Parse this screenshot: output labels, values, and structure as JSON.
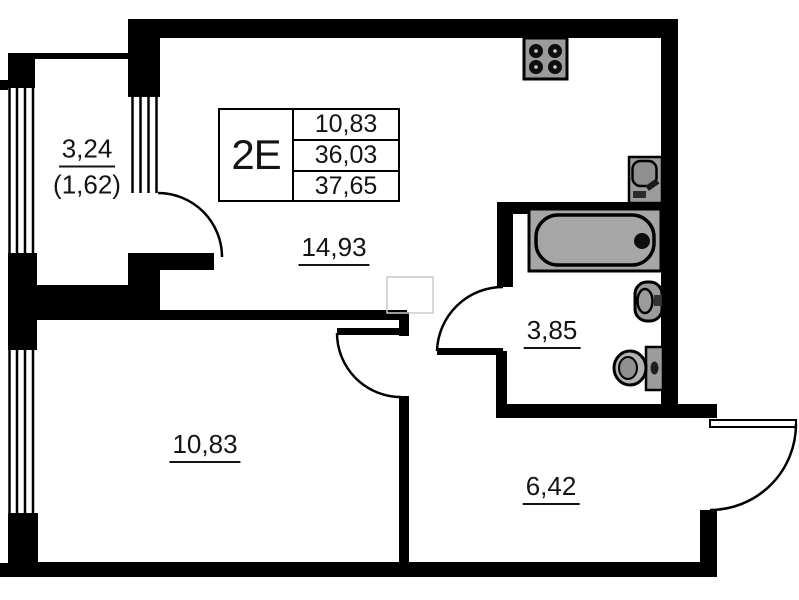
{
  "plan": {
    "title": "Apartment floor plan 2E",
    "info_box": {
      "type": "2E",
      "values": [
        "10,83",
        "36,03",
        "37,65"
      ]
    },
    "rooms": {
      "balcony": {
        "area": "3,24",
        "area_reduced": "(1,62)"
      },
      "kitchen_living": {
        "area": "14,93"
      },
      "bathroom": {
        "area": "3,85"
      },
      "bedroom": {
        "area": "10,83"
      },
      "hallway": {
        "area": "6,42"
      }
    },
    "fixtures": [
      "stove",
      "kitchen-sink",
      "bathtub",
      "washbasin",
      "toilet"
    ],
    "colors": {
      "wall": "#000000",
      "fixture_fill": "#9c9c9c",
      "background": "#ffffff",
      "text": "#141414"
    }
  }
}
